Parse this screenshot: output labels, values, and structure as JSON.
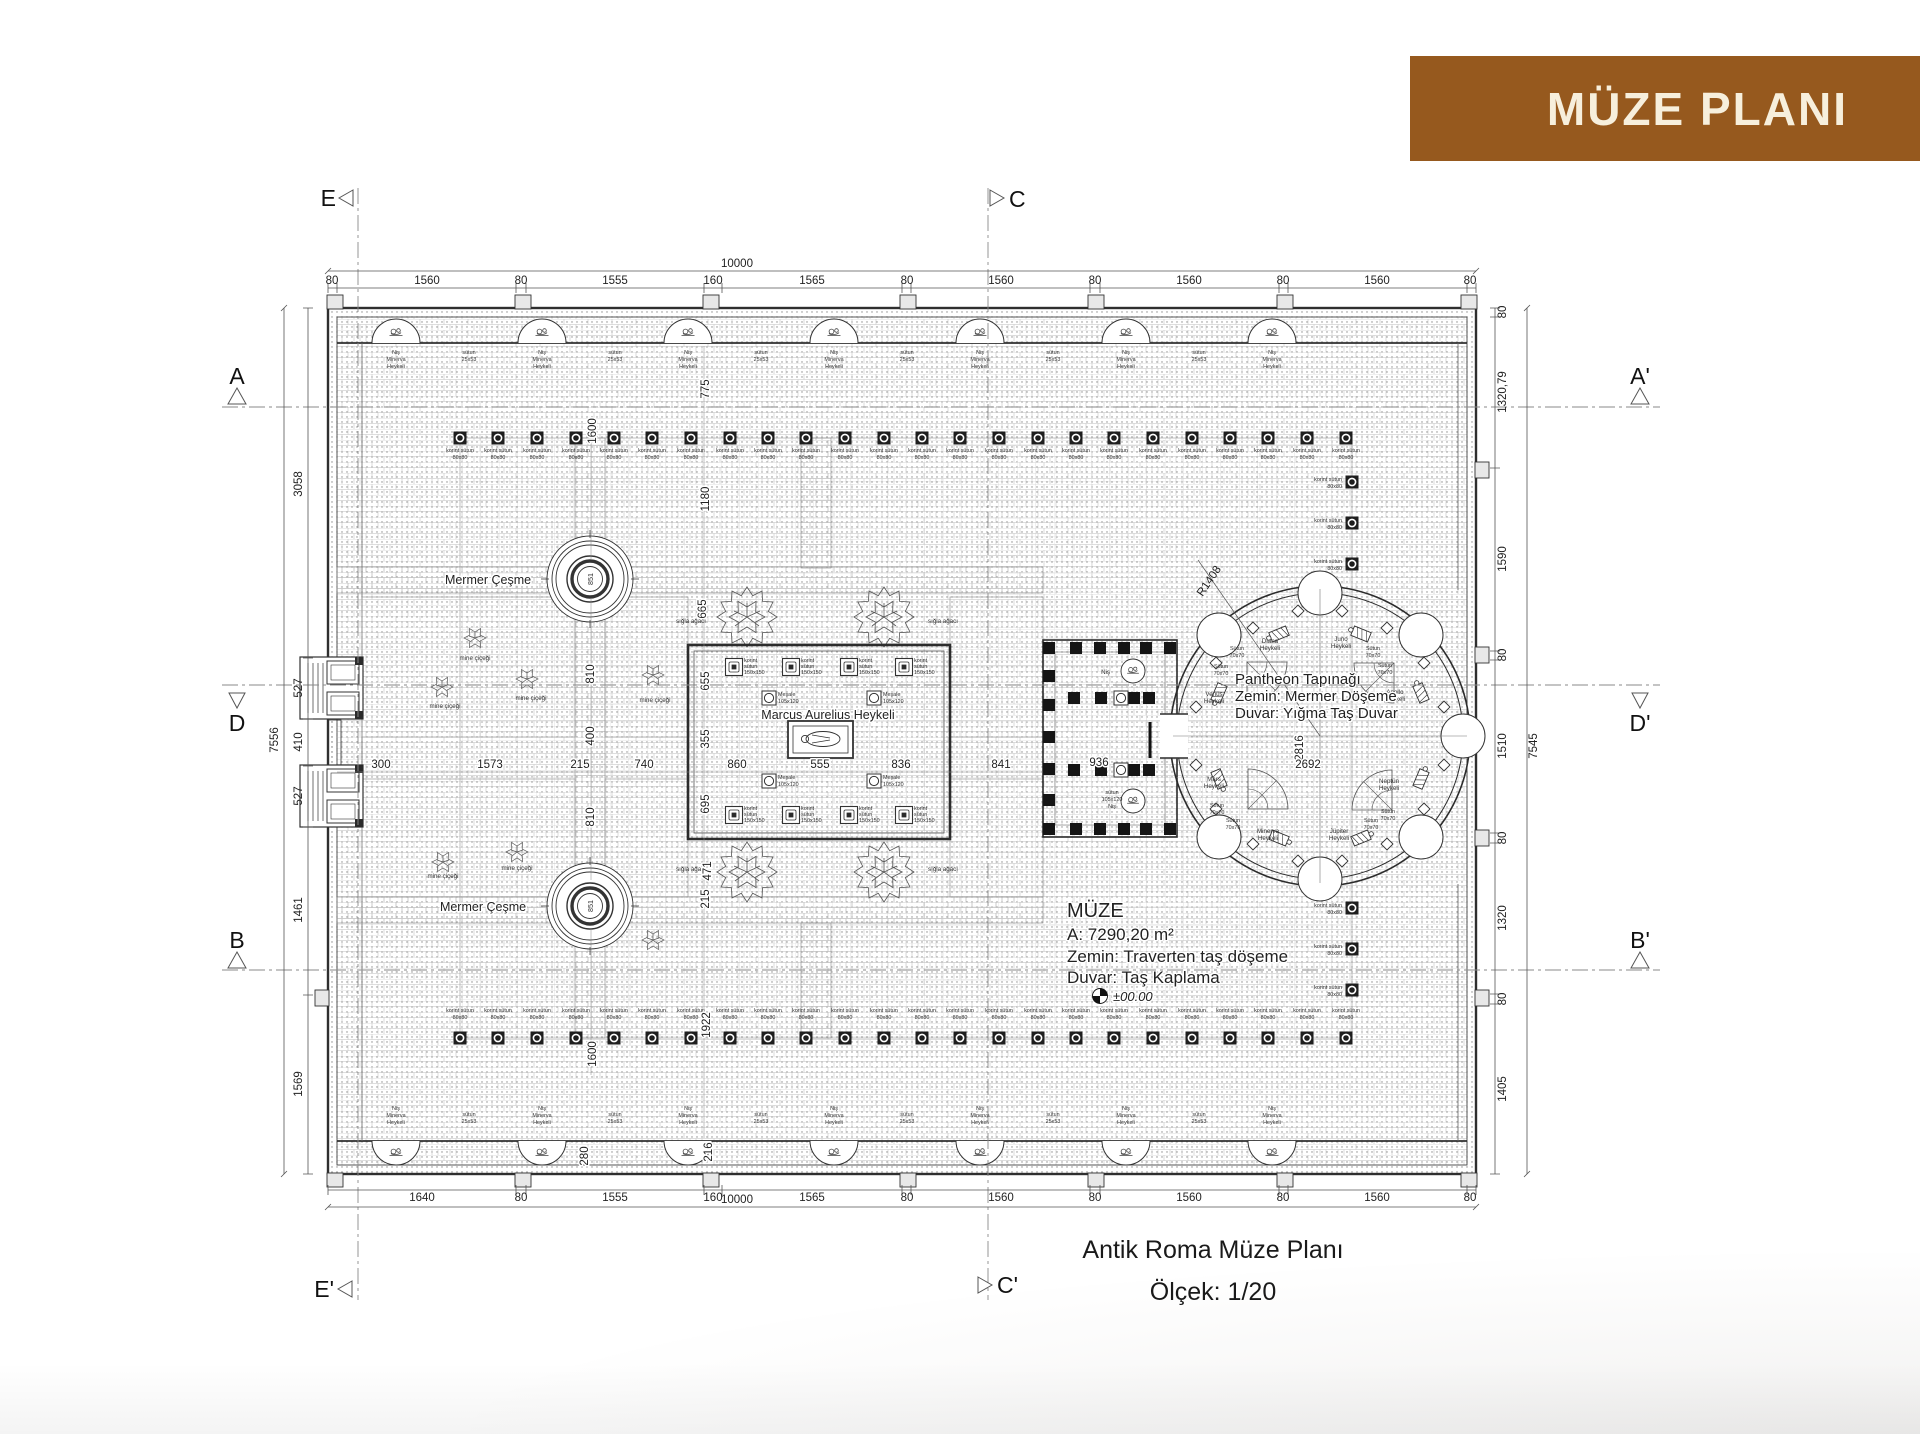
{
  "banner": {
    "title": "MÜZE PLANI"
  },
  "caption": {
    "line1": "Antik Roma Müze Planı",
    "line2": "Ölçek: 1/20"
  },
  "markers": {
    "E": "E",
    "C": "C",
    "E2": "E'",
    "C2": "C'",
    "A": "A",
    "A2": "A'",
    "D": "D",
    "D2": "D'",
    "B": "B",
    "B2": "B'"
  },
  "dims": {
    "overall_width": "10000",
    "top_segments": [
      "80",
      "1560",
      "80",
      "1555",
      "160",
      "1565",
      "80",
      "1560",
      "80",
      "1560",
      "80",
      "1560",
      "80"
    ],
    "bottom_segments": [
      "1640",
      "80",
      "1555",
      "160",
      "1565",
      "80",
      "1560",
      "80",
      "1560",
      "80",
      "1560",
      "80"
    ],
    "left_segments": [
      "3058",
      "527",
      "410",
      "527",
      "1461",
      "1569"
    ],
    "left_total": "7556",
    "right_segments": [
      "80",
      "1320,79",
      "1590",
      "80",
      "1510",
      "80",
      "1320",
      "80",
      "1405"
    ],
    "right_total": "7545",
    "interior": {
      "v775": "775",
      "v1600a": "1600",
      "v1180": "1180",
      "v665": "665",
      "v655": "655",
      "v355": "355",
      "v695": "695",
      "v471": "471",
      "v215": "215",
      "v1922": "1922",
      "v1600b": "1600",
      "v280": "280",
      "v216": "216",
      "v810a": "810",
      "v400": "400",
      "v810b": "810",
      "v2816": "2816",
      "h300": "300",
      "h1573": "1573",
      "h215": "215",
      "h740": "740",
      "h860": "860",
      "h555": "555",
      "h836": "836",
      "h841": "841",
      "h936": "936",
      "h2692": "2692",
      "r1408": "R1408",
      "f851": "851"
    }
  },
  "labels": {
    "mermer_cesme": "Mermer Çeşme",
    "marcus": "Marcus Aurelius Heykeli",
    "nis_minerva": {
      "l1": "Niş",
      "l2": "Minerva",
      "l3": "Heykeli"
    },
    "sutun_25x53": {
      "l1": "sütun",
      "l2": "25x53"
    },
    "korint_80": {
      "l1": "korint sütun",
      "l2": "80x80"
    },
    "korint_150": {
      "l1": "korint",
      "l2": "sütun",
      "l3": "150x150"
    },
    "mesale": {
      "l1": "Meşale",
      "l2": "105x120"
    },
    "sigla": "sığla ağacı",
    "mine": "mine çiçeği",
    "sutun_70": {
      "l1": "Sütun",
      "l2": "70x70"
    },
    "nis": "Niş",
    "sutun_105": {
      "l1": "sütun",
      "l2": "105x120",
      "l3": "Niş"
    },
    "level": "±00.00"
  },
  "pantheon": {
    "title": "Pantheon Tapınağı",
    "floor": "Zemin: Mermer Döşeme",
    "wall": "Duvar: Yığma Taş Duvar",
    "statues": [
      {
        "l1": "Diana",
        "l2": "Heykeli"
      },
      {
        "l1": "Juno",
        "l2": "Heykeli"
      },
      {
        "l1": "Venüs",
        "l2": "Heykeli"
      },
      {
        "l1": "Apollo",
        "l2": "Heykeli"
      },
      {
        "l1": "Mars",
        "l2": "Heykeli"
      },
      {
        "l1": "Neptün",
        "l2": "Heykeli"
      },
      {
        "l1": "Minerva",
        "l2": "Heykeli"
      },
      {
        "l1": "Jüpiter",
        "l2": "Heykeli"
      }
    ]
  },
  "muze": {
    "name": "MÜZE",
    "area": "A: 7290,20 m²",
    "floor": "Zemin: Traverten taş döşeme",
    "wall": "Duvar: Taş Kaplama"
  },
  "colors": {
    "banner": "#96591E",
    "banner_text": "#F7EFDC",
    "line": "#3a3a3a"
  }
}
